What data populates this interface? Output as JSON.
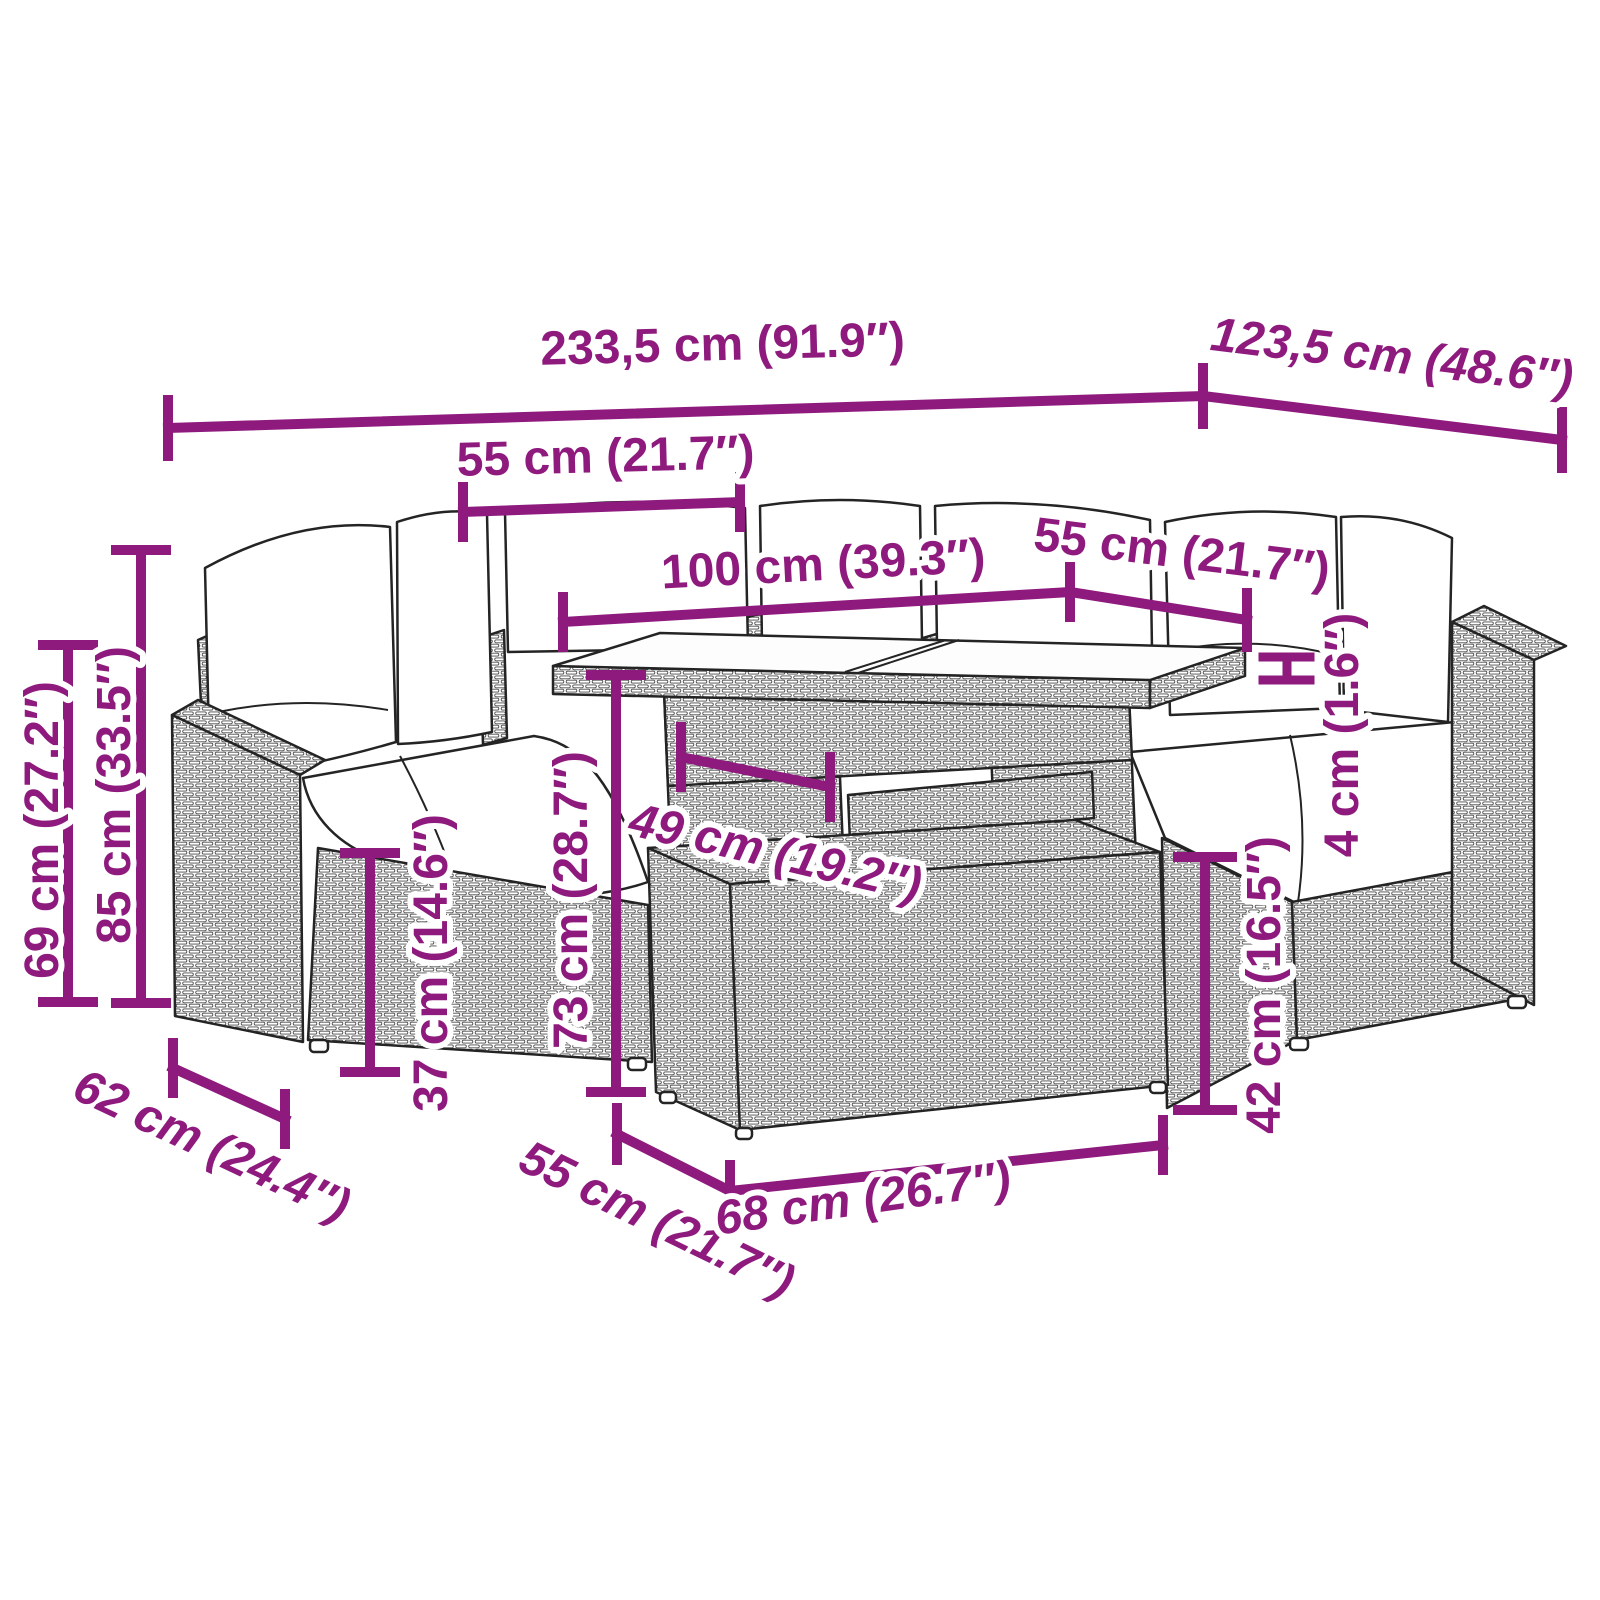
{
  "diagram": {
    "kind": "product-dimension-diagram",
    "subject": "poly-rattan-garden-lounge-set-with-table-and-ottoman",
    "background_color": "#ffffff",
    "dimension_color": "#8E1A7E",
    "line_art_color": "#242424"
  },
  "dimensions": {
    "overall_width": {
      "label": "233,5 cm (91.9″)",
      "value_cm": 233.5,
      "value_in": 91.9
    },
    "overall_depth": {
      "label": "123,5 cm (48.6″)",
      "value_cm": 123.5,
      "value_in": 48.6
    },
    "section_width": {
      "label": "55 cm (21.7″)",
      "value_cm": 55,
      "value_in": 21.7
    },
    "table_length": {
      "label": "100 cm (39.3″)",
      "value_cm": 100,
      "value_in": 39.3
    },
    "right_section_width": {
      "label": "55 cm (21.7″)",
      "value_cm": 55,
      "value_in": 21.7
    },
    "armrest_height": {
      "label": "69 cm (27.2″)",
      "value_cm": 69,
      "value_in": 27.2
    },
    "total_height": {
      "label": "85 cm (33.5″)",
      "value_cm": 85,
      "value_in": 33.5
    },
    "seat_height": {
      "label": "37 cm (14.6″)",
      "value_cm": 37,
      "value_in": 14.6
    },
    "table_height": {
      "label": "73 cm (28.7″)",
      "value_cm": 73,
      "value_in": 28.7
    },
    "table_inner_width": {
      "label": "49 cm (19.2″)",
      "value_cm": 49,
      "value_in": 19.2
    },
    "tabletop_thickness": {
      "label": "4 cm (1.6″)",
      "value_cm": 4,
      "value_in": 1.6
    },
    "ottoman_height": {
      "label": "42 cm (16.5″)",
      "value_cm": 42,
      "value_in": 16.5
    },
    "seat_depth": {
      "label": "62 cm (24.4″)",
      "value_cm": 62,
      "value_in": 24.4
    },
    "ottoman_depth": {
      "label": "55 cm (21.7″)",
      "value_cm": 55,
      "value_in": 21.7
    },
    "ottoman_width": {
      "label": "68 cm (26.7″)",
      "value_cm": 68,
      "value_in": 26.7
    }
  }
}
